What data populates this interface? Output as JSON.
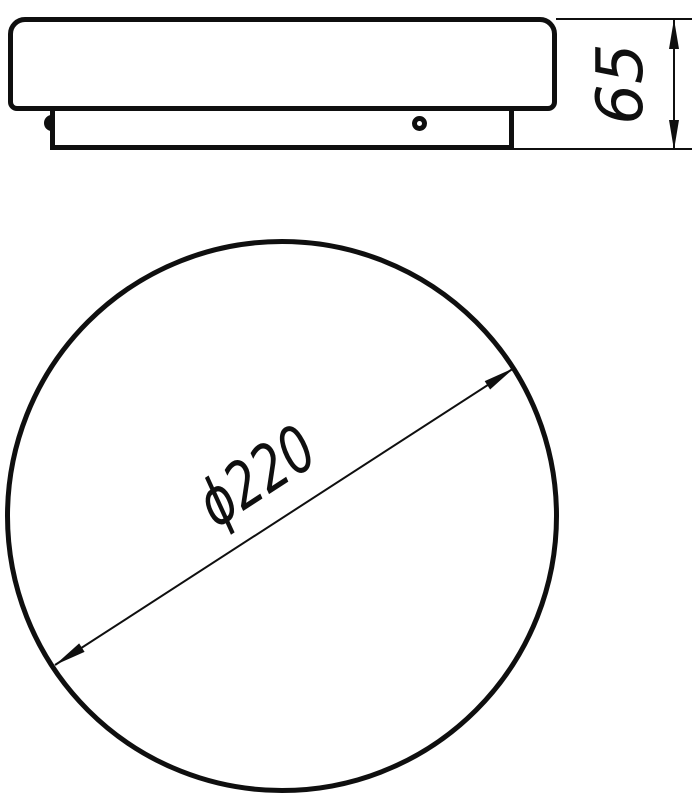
{
  "page": {
    "background_color": "#ffffff",
    "line_color": "#0f0f0f"
  },
  "drawing": {
    "type": "technical-drawing",
    "views": [
      {
        "id": "side-view",
        "description_elements": [
          "lamp-shade-profile",
          "mounting-base-profile",
          "clip-bump",
          "screw-hole"
        ]
      },
      {
        "id": "plan-view",
        "description_elements": [
          "lamp-circle-outline"
        ]
      }
    ],
    "dimensions": {
      "height": {
        "label": "65"
      },
      "diameter": {
        "label": "ϕ220"
      }
    }
  }
}
